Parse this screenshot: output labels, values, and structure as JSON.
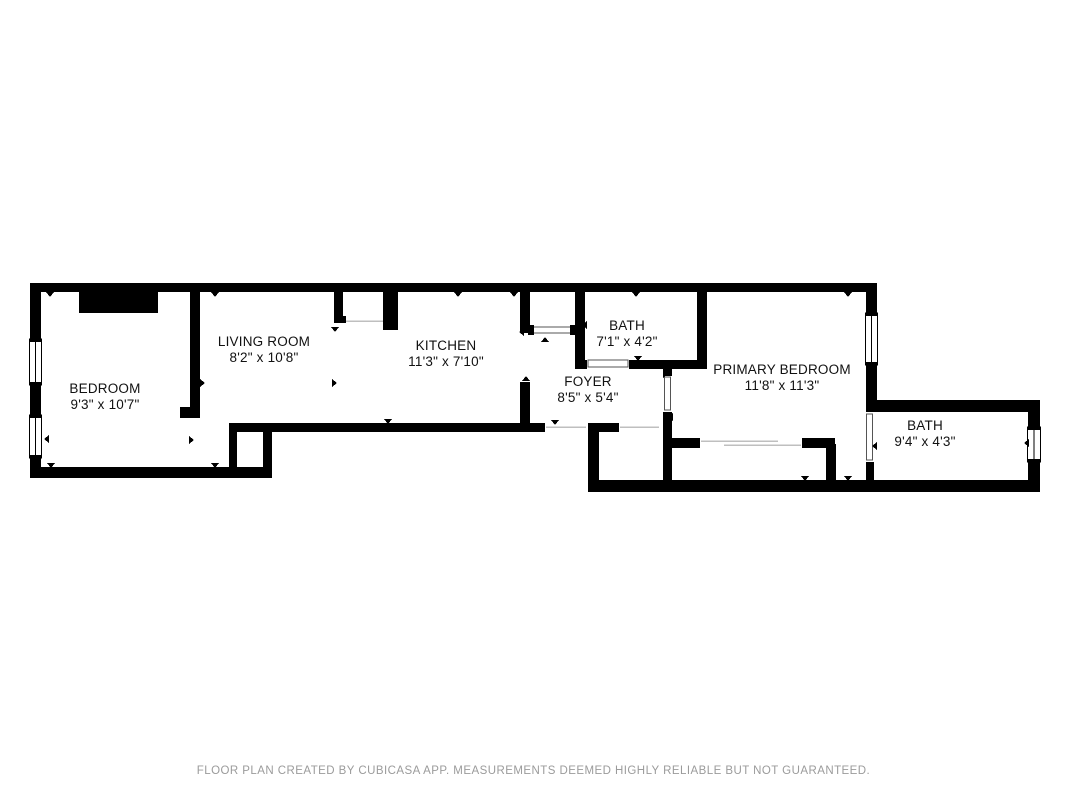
{
  "floor_plan": {
    "rooms": [
      {
        "id": "bedroom",
        "name": "BEDROOM",
        "dimensions": "9'3\" x 10'7\""
      },
      {
        "id": "living-room",
        "name": "LIVING ROOM",
        "dimensions": "8'2\" x 10'8\""
      },
      {
        "id": "kitchen",
        "name": "KITCHEN",
        "dimensions": "11'3\" x 7'10\""
      },
      {
        "id": "bath",
        "name": "BATH",
        "dimensions": "7'1\" x 4'2\""
      },
      {
        "id": "foyer",
        "name": "FOYER",
        "dimensions": "8'5\" x 5'4\""
      },
      {
        "id": "primary-bedroom",
        "name": "PRIMARY BEDROOM",
        "dimensions": "11'8\" x 11'3\""
      },
      {
        "id": "bath-2",
        "name": "BATH",
        "dimensions": "9'4\" x 4'3\""
      }
    ],
    "colors": {
      "wall": "#000000",
      "floor": "#ffffff",
      "background": "#ffffff",
      "label_text": "#111111",
      "footer_text": "#9b9b9b"
    }
  },
  "footer": {
    "disclaimer": "FLOOR PLAN CREATED BY CUBICASA APP. MEASUREMENTS DEEMED HIGHLY RELIABLE BUT NOT GUARANTEED."
  }
}
